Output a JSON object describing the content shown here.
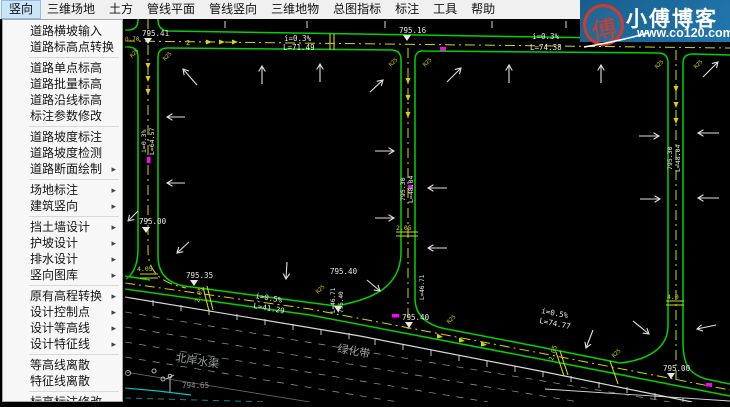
{
  "menu_bar": {
    "items": [
      {
        "label": "竖向",
        "active": true
      },
      {
        "label": "三维场地"
      },
      {
        "label": "土方"
      },
      {
        "label": "管线平面"
      },
      {
        "label": "管线竖向"
      },
      {
        "label": "三维地物"
      },
      {
        "label": "总图指标"
      },
      {
        "label": "标注"
      },
      {
        "label": "工具"
      },
      {
        "label": "帮助"
      }
    ]
  },
  "menu_panel": {
    "groups": [
      [
        {
          "label": "道路横坡输入"
        },
        {
          "label": "道路标高点转换"
        }
      ],
      [
        {
          "label": "道路单点标高"
        },
        {
          "label": "道路批量标高"
        },
        {
          "label": "道路沿线标高"
        },
        {
          "label": "标注参数修改"
        }
      ],
      [
        {
          "label": "道路坡度标注"
        },
        {
          "label": "道路坡度检测"
        },
        {
          "label": "道路断面绘制",
          "submenu": true
        }
      ],
      [
        {
          "label": "场地标注",
          "submenu": true
        },
        {
          "label": "建筑竖向",
          "submenu": true
        }
      ],
      [
        {
          "label": "挡土墙设计",
          "submenu": true
        },
        {
          "label": "护坡设计",
          "submenu": true
        },
        {
          "label": "排水设计",
          "submenu": true
        },
        {
          "label": "竖向图库",
          "submenu": true
        }
      ],
      [
        {
          "label": "原有高程转换",
          "submenu": true
        },
        {
          "label": "设计控制点",
          "submenu": true
        },
        {
          "label": "设计等高线",
          "submenu": true
        },
        {
          "label": "设计特征线",
          "submenu": true
        }
      ],
      [
        {
          "label": "等高线离散"
        },
        {
          "label": "特征线离散"
        }
      ],
      [
        {
          "label": "标高标注修改"
        },
        {
          "label": "场地断面计算"
        }
      ]
    ]
  },
  "logo": {
    "site_name": "小傅博客",
    "site_url": "www.co120.com",
    "seal_char": "傅",
    "bg_color": "#1e6ea6",
    "seal_color": "#d23b2a"
  },
  "canvas": {
    "bg": "#000000",
    "road_color": "#00d200",
    "centerline_color": "#d6d600",
    "annotation_color": "#e8e8e8",
    "muted_color": "#9aa0a0",
    "highlight_color": "#ff00ff",
    "labels": [
      {
        "t": "795.41",
        "x": 142,
        "y": 36
      },
      {
        "t": "795.16",
        "x": 399,
        "y": 33
      },
      {
        "t": "795.00",
        "x": 139,
        "y": 224
      },
      {
        "t": "795.35",
        "x": 186,
        "y": 278
      },
      {
        "t": "795.40",
        "x": 330,
        "y": 274
      },
      {
        "t": "795.40",
        "x": 402,
        "y": 320
      },
      {
        "t": "795.00",
        "x": 663,
        "y": 371
      },
      {
        "t": "i=0.3%",
        "x": 284,
        "y": 41
      },
      {
        "t": "L=71.49",
        "x": 283,
        "y": 50
      },
      {
        "t": "i=0.3%",
        "x": 532,
        "y": 39
      },
      {
        "t": "L=74.38",
        "x": 530,
        "y": 50
      },
      {
        "t": "i=0.5%",
        "x": 255,
        "y": 298,
        "r": 10
      },
      {
        "t": "L=41.29",
        "x": 253,
        "y": 308,
        "r": 10
      },
      {
        "t": "i=0.5%",
        "x": 541,
        "y": 313,
        "r": 11
      },
      {
        "t": "L=74.77",
        "x": 539,
        "y": 323,
        "r": 11
      },
      {
        "t": "795.30",
        "x": 405,
        "y": 201,
        "r": -90,
        "s": 6.5
      },
      {
        "t": "L=48.04",
        "x": 413,
        "y": 203,
        "r": -90,
        "s": 6.5
      },
      {
        "t": "i=0.3%",
        "x": 146,
        "y": 153,
        "r": -90,
        "s": 6.5
      },
      {
        "t": "L=64.57",
        "x": 154,
        "y": 155,
        "r": -90,
        "s": 6.5
      },
      {
        "t": "795.30",
        "x": 672,
        "y": 170,
        "r": -90,
        "s": 6.5
      },
      {
        "t": "L=48.04",
        "x": 680,
        "y": 172,
        "r": -90,
        "s": 6.5
      },
      {
        "t": "L=46.71",
        "x": 335,
        "y": 313,
        "r": -90,
        "s": 6
      },
      {
        "t": "795.40",
        "x": 343,
        "y": 313,
        "r": -90,
        "s": 6
      },
      {
        "t": "L=46.71",
        "x": 424,
        "y": 300,
        "r": -90,
        "s": 6
      },
      {
        "t": "2.05",
        "x": 396,
        "y": 230,
        "c": "#d6d600",
        "s": 6.5
      },
      {
        "t": "4.05",
        "x": 137,
        "y": 271,
        "c": "#d6d600",
        "s": 6.5
      },
      {
        "t": "2.05",
        "x": 199,
        "y": 303,
        "c": "#d6d600",
        "s": 6.5,
        "r": -75
      },
      {
        "t": "4.0",
        "x": 667,
        "y": 299,
        "c": "#d6d600",
        "s": 6.5
      },
      {
        "t": "2",
        "x": 186,
        "y": 45,
        "c": "#d6d600",
        "s": 7
      },
      {
        "t": "2.05",
        "x": 553,
        "y": 361,
        "c": "#d6d600",
        "s": 6.5,
        "r": -75
      },
      {
        "t": "0.70",
        "x": 125,
        "y": 41,
        "c": "#d6d600",
        "s": 6
      },
      {
        "t": "R25",
        "x": 132,
        "y": 58,
        "c": "#c8c800",
        "s": 5.5,
        "r": -45
      },
      {
        "t": "R25",
        "x": 165,
        "y": 61,
        "c": "#c8c800",
        "s": 5.5,
        "r": -45
      },
      {
        "t": "R25",
        "x": 391,
        "y": 67,
        "c": "#c8c800",
        "s": 5.5,
        "r": -45
      },
      {
        "t": "R25",
        "x": 425,
        "y": 67,
        "c": "#c8c800",
        "s": 5.5,
        "r": -45
      },
      {
        "t": "R25",
        "x": 657,
        "y": 69,
        "c": "#c8c800",
        "s": 5.5,
        "r": -45
      },
      {
        "t": "R25",
        "x": 696,
        "y": 69,
        "c": "#c8c800",
        "s": 5.5,
        "r": -45
      },
      {
        "t": "R25",
        "x": 318,
        "y": 294,
        "c": "#c8c800",
        "s": 5.5,
        "r": -45
      },
      {
        "t": "R25",
        "x": 449,
        "y": 324,
        "c": "#c8c800",
        "s": 5.5,
        "r": -45
      },
      {
        "t": "R25",
        "x": 614,
        "y": 358,
        "c": "#c8c800",
        "s": 5.5,
        "r": -45
      },
      {
        "t": "北岸水渠",
        "x": 175,
        "y": 361,
        "c": "#9aa0a0",
        "s": 11,
        "r": 9,
        "f": "sans"
      },
      {
        "t": "绿化带",
        "x": 337,
        "y": 352,
        "c": "#9aa0a0",
        "s": 11,
        "r": 10,
        "f": "sans"
      },
      {
        "t": "794.65",
        "x": 182,
        "y": 388,
        "c": "#8f8f8f",
        "s": 7.5
      }
    ],
    "elevation_markers": [
      {
        "x": 148,
        "y": 38
      },
      {
        "x": 407,
        "y": 35
      },
      {
        "x": 146,
        "y": 227
      },
      {
        "x": 194,
        "y": 280
      },
      {
        "x": 338,
        "y": 306
      },
      {
        "x": 409,
        "y": 322
      },
      {
        "x": 671,
        "y": 373
      }
    ]
  }
}
